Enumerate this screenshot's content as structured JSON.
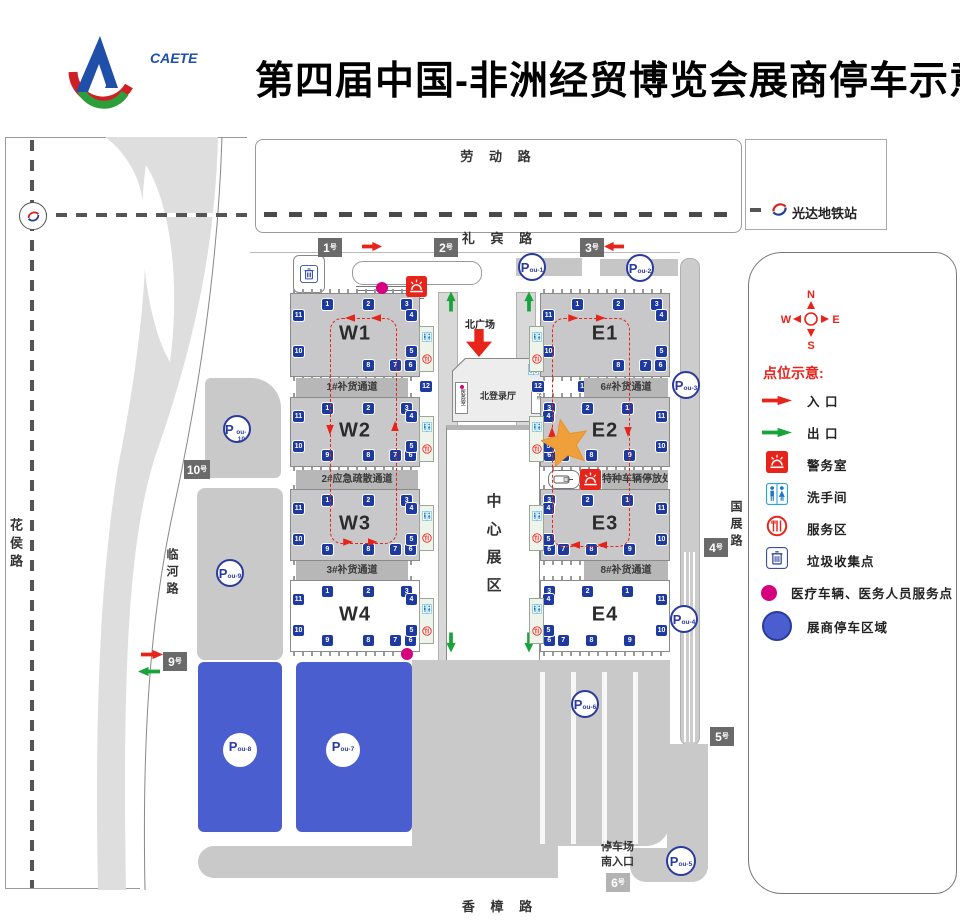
{
  "header": {
    "logo_text": "CAETE",
    "title": "第四届中国-非洲经贸博览会展商停车示意图"
  },
  "roads": {
    "laodong": "劳 动 路",
    "libin": "礼 宾 路",
    "huahou": "花侯路",
    "linhe": "临河路",
    "guozhan": "国展路",
    "xiangzhang": "香 樟 路"
  },
  "metro": {
    "station": "光达地铁站"
  },
  "compass": {
    "n": "N",
    "s": "S",
    "w": "W",
    "e": "E"
  },
  "center": {
    "north_plaza": "北广场",
    "north_hall": "北登录厅",
    "main_hall": "中心展区",
    "left_room": "医务室",
    "right_room": "服务点"
  },
  "south": {
    "entrance_line1": "停车场",
    "entrance_line2": "南入口"
  },
  "legend": {
    "title": "点位示意:",
    "items": [
      {
        "icon": "entrance-arrow",
        "label": "入 口"
      },
      {
        "icon": "exit-arrow",
        "label": "出 口"
      },
      {
        "icon": "police",
        "label": "警务室"
      },
      {
        "icon": "restroom",
        "label": "洗手间"
      },
      {
        "icon": "service",
        "label": "服务区"
      },
      {
        "icon": "trash",
        "label": "垃圾收集点"
      },
      {
        "icon": "medical-dot",
        "label": "医疗车辆、医务人员服务点"
      },
      {
        "icon": "parking-zone",
        "label": "展商停车区域"
      }
    ]
  },
  "colors": {
    "red": "#e8231a",
    "green": "#18a43b",
    "dock_blue": "#1e3a9f",
    "parking_blue": "#4a5ed0",
    "ring_blue": "#2b3a9e",
    "magenta": "#d6007f",
    "hall_gray": "#c8c8ca",
    "lot_gray": "#c9c9c9",
    "gate_dark": "#6a6a6a",
    "star_orange": "#f0a03a"
  },
  "map": {
    "gate_suffix": "号",
    "halls": [
      {
        "id": "W1",
        "label": "W1",
        "x": 290,
        "y": 293,
        "w": 128,
        "h": 82,
        "gray": true,
        "mirrored": false,
        "docks": {
          "top": [
            1,
            2,
            3
          ],
          "right": [
            4,
            5
          ],
          "bottom": [
            8,
            7,
            6
          ],
          "left": [
            11,
            10
          ]
        }
      },
      {
        "id": "W2",
        "label": "W2",
        "x": 290,
        "y": 397,
        "w": 128,
        "h": 68,
        "gray": true,
        "mirrored": false,
        "docks": {
          "top": [
            1,
            2,
            3
          ],
          "right": [
            4,
            5
          ],
          "bottom": [
            9,
            8,
            7,
            6
          ],
          "left": [
            11,
            10
          ]
        }
      },
      {
        "id": "W3",
        "label": "W3",
        "x": 290,
        "y": 489,
        "w": 128,
        "h": 70,
        "gray": true,
        "mirrored": false,
        "docks": {
          "top": [
            1,
            2,
            3
          ],
          "right": [
            4,
            5
          ],
          "bottom": [
            9,
            8,
            7,
            6
          ],
          "left": [
            11,
            10
          ]
        }
      },
      {
        "id": "W4",
        "label": "W4",
        "x": 290,
        "y": 580,
        "w": 128,
        "h": 70,
        "gray": false,
        "mirrored": false,
        "docks": {
          "top": [
            1,
            2,
            3
          ],
          "right": [
            4,
            5
          ],
          "bottom": [
            9,
            8,
            7,
            6
          ],
          "left": [
            11,
            10
          ]
        }
      },
      {
        "id": "E1",
        "label": "E1",
        "x": 540,
        "y": 293,
        "w": 128,
        "h": 82,
        "gray": true,
        "mirrored": false,
        "docks": {
          "top": [
            1,
            2,
            3
          ],
          "right": [
            4,
            5
          ],
          "bottom": [
            8,
            7,
            6
          ],
          "left": [
            11,
            10
          ]
        }
      },
      {
        "id": "E2",
        "label": "E2",
        "x": 540,
        "y": 397,
        "w": 128,
        "h": 68,
        "gray": true,
        "mirrored": true,
        "docks": {
          "top": [
            3,
            2,
            1
          ],
          "left": [
            4,
            5
          ],
          "bottom": [
            6,
            7,
            8,
            9
          ],
          "right": [
            11,
            10
          ]
        }
      },
      {
        "id": "E3",
        "label": "E3",
        "x": 540,
        "y": 489,
        "w": 128,
        "h": 70,
        "gray": true,
        "mirrored": true,
        "docks": {
          "top": [
            3,
            2,
            1
          ],
          "left": [
            4,
            5
          ],
          "bottom": [
            6,
            7,
            8,
            9
          ],
          "right": [
            11,
            10
          ]
        }
      },
      {
        "id": "E4",
        "label": "E4",
        "x": 540,
        "y": 580,
        "w": 128,
        "h": 70,
        "gray": false,
        "mirrored": true,
        "docks": {
          "top": [
            3,
            2,
            1
          ],
          "left": [
            4,
            5
          ],
          "bottom": [
            6,
            7,
            8,
            9
          ],
          "right": [
            11,
            10
          ]
        }
      }
    ],
    "corridor_docks": [
      {
        "n": "13",
        "x": 368,
        "y": 381
      },
      {
        "n": "12",
        "x": 420,
        "y": 381
      },
      {
        "n": "12",
        "x": 532,
        "y": 381
      },
      {
        "n": "13",
        "x": 578,
        "y": 381
      }
    ],
    "channels": [
      {
        "label": "1#补货通道",
        "x": 296,
        "y": 378,
        "w": 112,
        "h": 19
      },
      {
        "label": "6#补货通道",
        "x": 584,
        "y": 378,
        "w": 84,
        "h": 19
      },
      {
        "label": "2#应急疏散通道",
        "x": 296,
        "y": 470,
        "w": 122,
        "h": 19
      },
      {
        "label": "3#补货通道",
        "x": 296,
        "y": 561,
        "w": 112,
        "h": 19
      },
      {
        "label": "8#补货通道",
        "x": 584,
        "y": 561,
        "w": 84,
        "h": 19
      },
      {
        "label": "特种车辆停放处",
        "x": 602,
        "y": 470,
        "w": 66,
        "h": 19
      }
    ],
    "gates": [
      {
        "label": "1",
        "x": 318,
        "y": 238,
        "variant": "dark"
      },
      {
        "label": "2",
        "x": 434,
        "y": 238,
        "variant": "dark"
      },
      {
        "label": "3",
        "x": 580,
        "y": 238,
        "variant": "dark"
      },
      {
        "label": "10",
        "x": 184,
        "y": 460,
        "variant": "dark"
      },
      {
        "label": "9",
        "x": 163,
        "y": 652,
        "variant": "dark"
      },
      {
        "label": "4",
        "x": 704,
        "y": 538,
        "variant": "dark"
      },
      {
        "label": "5",
        "x": 710,
        "y": 727,
        "variant": "dark"
      },
      {
        "label": "6",
        "x": 606,
        "y": 873,
        "variant": "light"
      }
    ],
    "parking": [
      {
        "sub": "ou-1",
        "x": 518,
        "y": 253,
        "d": 28,
        "style": "ring"
      },
      {
        "sub": "ou-2",
        "x": 626,
        "y": 254,
        "d": 28,
        "style": "ring"
      },
      {
        "sub": "ou-3",
        "x": 672,
        "y": 371,
        "d": 28,
        "style": "ring"
      },
      {
        "sub": "ou-4",
        "x": 670,
        "y": 605,
        "d": 28,
        "style": "ring"
      },
      {
        "sub": "ou-5",
        "x": 666,
        "y": 846,
        "d": 30,
        "style": "ring"
      },
      {
        "sub": "ou-6",
        "x": 571,
        "y": 690,
        "d": 28,
        "style": "ring"
      },
      {
        "sub": "ou-7",
        "x": 326,
        "y": 733,
        "d": 34,
        "style": "solid"
      },
      {
        "sub": "ou-8",
        "x": 223,
        "y": 733,
        "d": 34,
        "style": "solid"
      },
      {
        "sub": "ou-9",
        "x": 216,
        "y": 559,
        "d": 28,
        "style": "ring"
      },
      {
        "sub": "ou-10",
        "x": 223,
        "y": 415,
        "d": 28,
        "style": "ring"
      }
    ],
    "medical_dots": [
      {
        "x": 376,
        "y": 282
      },
      {
        "x": 401,
        "y": 648
      }
    ],
    "police": [
      {
        "x": 406,
        "y": 276
      },
      {
        "x": 580,
        "y": 469
      }
    ],
    "arrows": [
      {
        "color": "red",
        "dir": "right",
        "x": 362,
        "y": 241,
        "len": 20
      },
      {
        "color": "red",
        "dir": "left",
        "x": 604,
        "y": 241,
        "len": 20
      },
      {
        "color": "red",
        "dir": "right",
        "x": 141,
        "y": 649,
        "len": 22
      },
      {
        "color": "green",
        "dir": "left",
        "x": 138,
        "y": 666,
        "len": 22
      },
      {
        "color": "green",
        "dir": "up",
        "x": 441,
        "y": 296,
        "len": 20
      },
      {
        "color": "green",
        "dir": "up",
        "x": 519,
        "y": 296,
        "len": 20
      },
      {
        "color": "green",
        "dir": "down",
        "x": 441,
        "y": 637,
        "len": 20
      },
      {
        "color": "green",
        "dir": "down",
        "x": 519,
        "y": 637,
        "len": 20
      }
    ],
    "loops": [
      {
        "x": 330,
        "y": 318,
        "w": 65,
        "h": 224,
        "heads": [
          {
            "dir": "left",
            "fx": 0.3,
            "side": "top"
          },
          {
            "dir": "left",
            "fx": 0.7,
            "side": "top"
          },
          {
            "dir": "right",
            "fx": 0.28,
            "side": "bottom"
          },
          {
            "dir": "right",
            "fx": 0.66,
            "side": "bottom"
          },
          {
            "dir": "down",
            "fy": 0.5,
            "side": "left"
          },
          {
            "dir": "up",
            "fy": 0.48,
            "side": "right"
          }
        ]
      },
      {
        "x": 552,
        "y": 318,
        "w": 76,
        "h": 227,
        "heads": [
          {
            "dir": "right",
            "fx": 0.28,
            "side": "top"
          },
          {
            "dir": "right",
            "fx": 0.64,
            "side": "top"
          },
          {
            "dir": "left",
            "fx": 0.3,
            "side": "bottom"
          },
          {
            "dir": "left",
            "fx": 0.66,
            "side": "bottom"
          },
          {
            "dir": "up",
            "fy": 0.5,
            "side": "left"
          },
          {
            "dir": "down",
            "fy": 0.5,
            "side": "right"
          }
        ]
      }
    ],
    "service_strips": [
      {
        "x": 419,
        "y": 326
      },
      {
        "x": 419,
        "y": 416
      },
      {
        "x": 419,
        "y": 505
      },
      {
        "x": 419,
        "y": 598
      },
      {
        "x": 529,
        "y": 326
      },
      {
        "x": 529,
        "y": 416
      },
      {
        "x": 529,
        "y": 505
      },
      {
        "x": 529,
        "y": 598
      }
    ],
    "star": {
      "x": 565,
      "y": 442,
      "size": 48
    }
  }
}
